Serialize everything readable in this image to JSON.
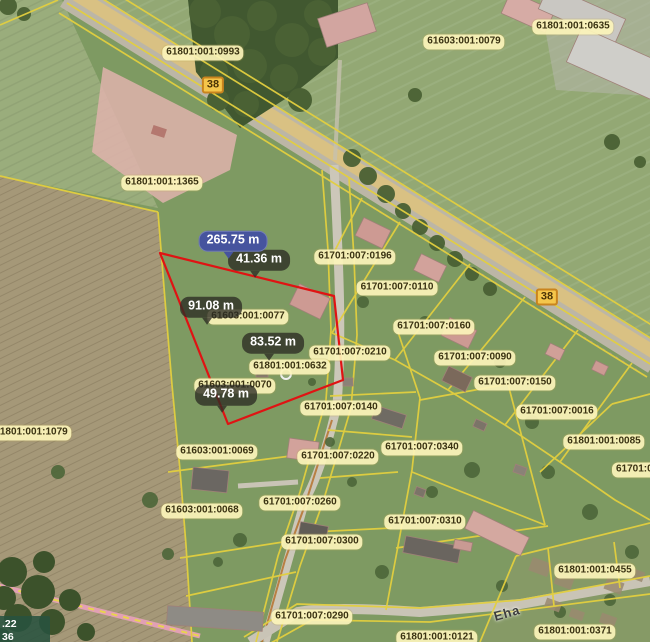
{
  "app": {
    "type": "cadastral-map-viewer"
  },
  "parcel_labels": [
    "61801:001:0993",
    "61603:001:0079",
    "61801:001:0635",
    "61801:001:1365",
    "61701:007:0196",
    "61701:007:0110",
    "61701:007:0160",
    "61603:001:0077",
    "61701:007:0090",
    "61701:007:0210",
    "61801:001:0632",
    "61701:007:0150",
    "61603:001:0070",
    "61701:007:0140",
    "61701:007:0016",
    "61801:001:1079",
    "61801:001:0085",
    "61603:001:0069",
    "61701:007:0220",
    "61701:007:0340",
    "61701:00",
    "61603:001:0068",
    "61701:007:0260",
    "61701:007:0310",
    "61701:007:0300",
    "61801:001:0455",
    "61701:007:0290",
    "61801:001:0371",
    "61801:001:0121"
  ],
  "road_badges": [
    "38",
    "38"
  ],
  "measurements": {
    "total": "265.75 m",
    "seg1": "41.36 m",
    "seg2": "91.08 m",
    "seg3": "83.52 m",
    "seg4": "49.78 m"
  },
  "street_name": "Eha",
  "coord_box": {
    "line1": ".22",
    "line2": "36"
  },
  "colors": {
    "measure_line": "#e01313",
    "total_badge_bg": "#46549e",
    "segment_badge_bg": "rgba(44,44,36,0.78)",
    "parcel_label_bg": "#fcf4ba",
    "road_badge_bg": "#f5c64b",
    "cadastral_line": "#e3cf3f"
  },
  "icons": [
    "measurement-vertex-marker"
  ]
}
